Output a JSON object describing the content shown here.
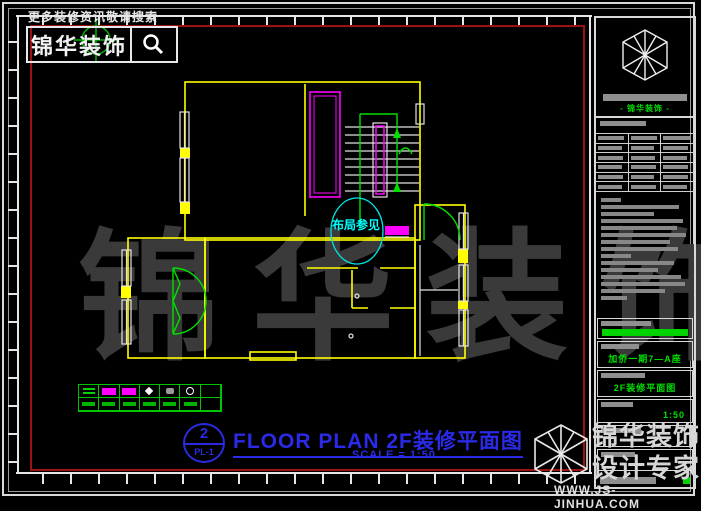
{
  "colors": {
    "background": "#000000",
    "wall_yellow": "#ffff00",
    "detail_magenta": "#ff00ff",
    "annotation_green": "#00e000",
    "label_cyan": "#00ffff",
    "title_blue": "#2a2ae8",
    "frame_red": "#9c1212",
    "frame_white": "#e6e6e6",
    "placeholder_gray": "#8f8f8f",
    "watermark_gray": "#3a3a3a"
  },
  "topbar": {
    "search_hint": "更多装修资讯敬请搜索",
    "brand": "锦华装饰",
    "search_icon": "magnifier-icon"
  },
  "plan": {
    "room_label": "布局参见",
    "legend_symbols": [
      "green-lines",
      "magenta-rect",
      "magenta-rect",
      "white-diamond",
      "gray-mark",
      "white-circle",
      "none"
    ]
  },
  "sheet_title": {
    "number": "2",
    "code": "PL-1",
    "title": "FLOOR PLAN 2F装修平面图",
    "scale": "SCALE = 1:50"
  },
  "titleblock": {
    "logo": "cube-logo-icon",
    "company": "- 锦华装饰 -",
    "project": "加侨一期7—A座",
    "drawing_name": "2F装修平面图",
    "scale": "1:50"
  },
  "watermark": {
    "center": "锦华装饰",
    "corner_brand": "锦华装饰",
    "corner_tagline": "设计专家",
    "website": "WWW.JS-JINHUA.COM"
  }
}
